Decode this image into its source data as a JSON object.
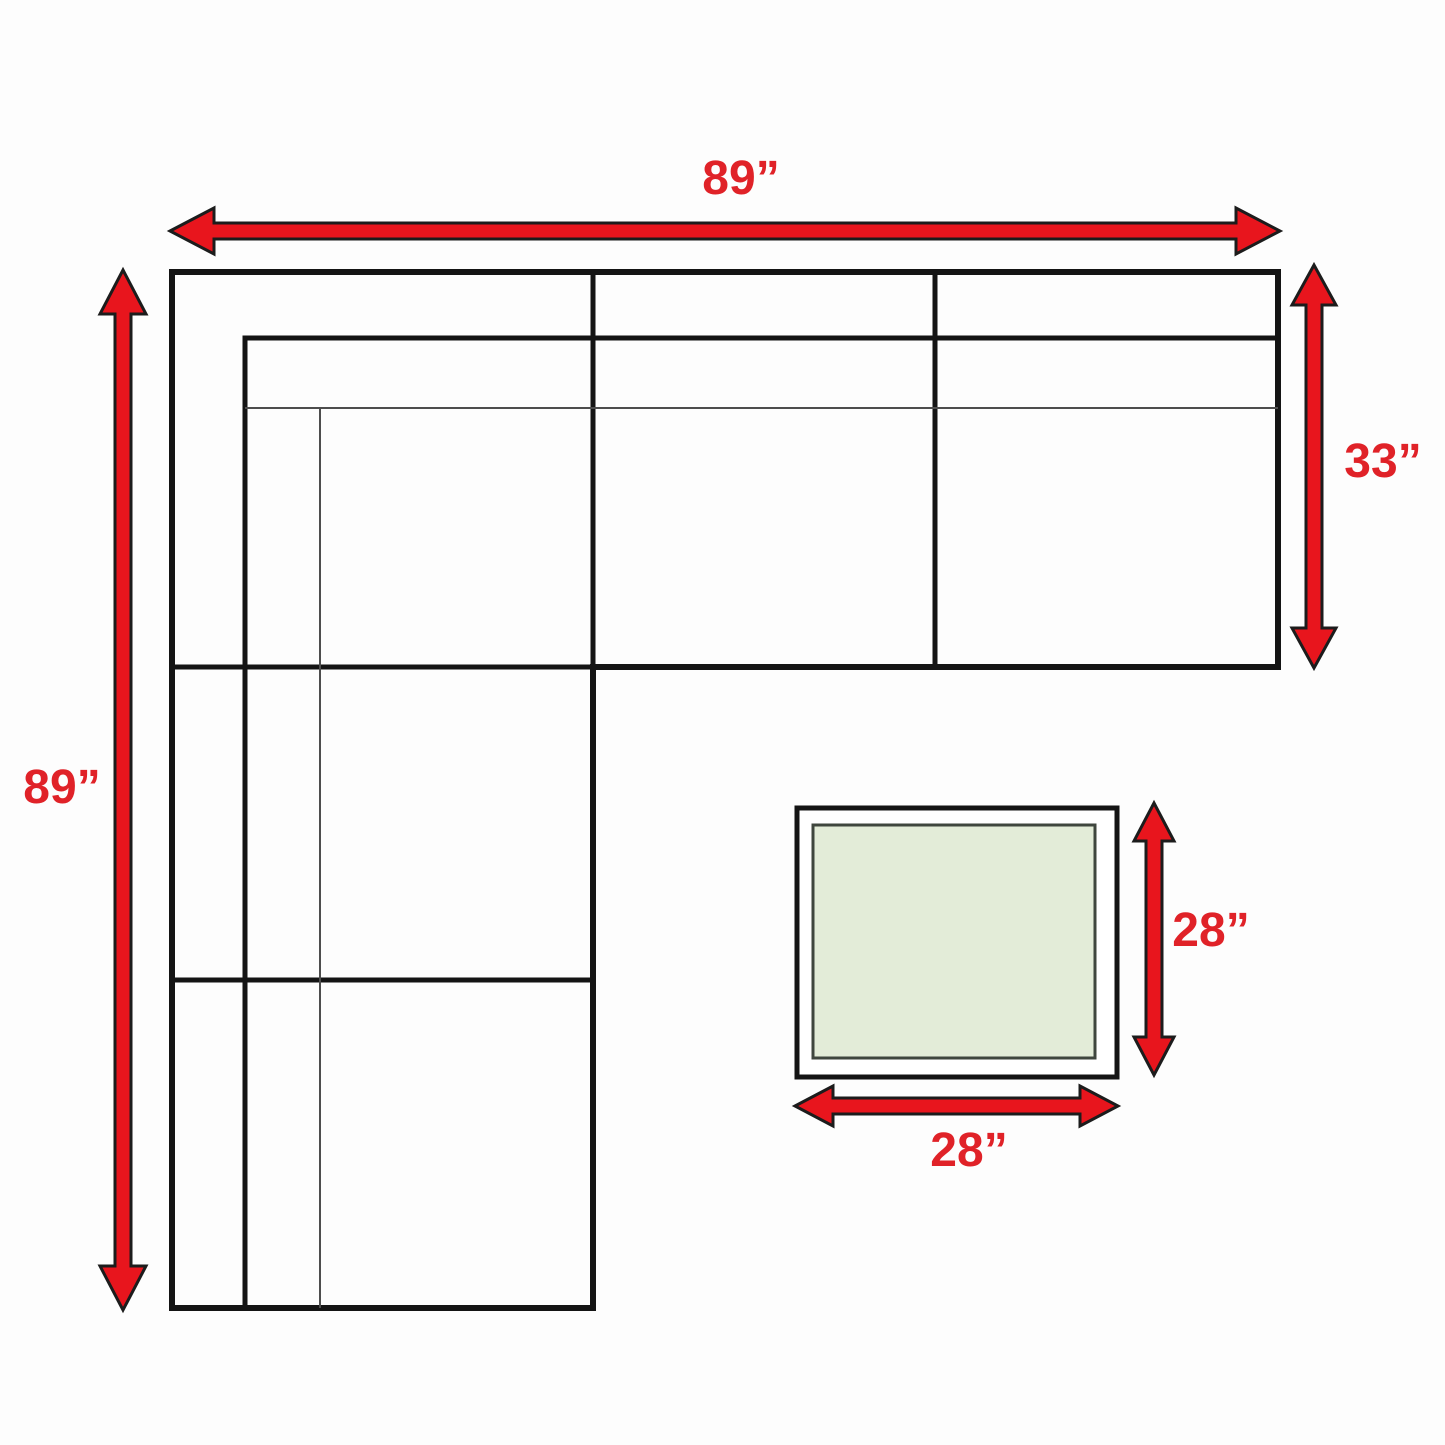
{
  "page": {
    "title": "Sectional sofa and end table dimension diagram",
    "background": "#fdfdfd"
  },
  "colors": {
    "arrow_fill": "#e8151d",
    "arrow_outline": "#1c1c1c",
    "label_red": "#e02228",
    "sofa_line": "#141414",
    "sofa_thin_line": "#4d4d4d",
    "table_outer_fill": "#ffffff",
    "table_outer_border": "#141414",
    "table_inner_fill": "#e3ecd8",
    "table_inner_border": "#3f463e"
  },
  "sofa": {
    "overall_width_label": "89”",
    "overall_depth_label": "89”",
    "section_depth_label": "33”"
  },
  "table": {
    "depth_label": "28”",
    "width_label": "28”"
  }
}
